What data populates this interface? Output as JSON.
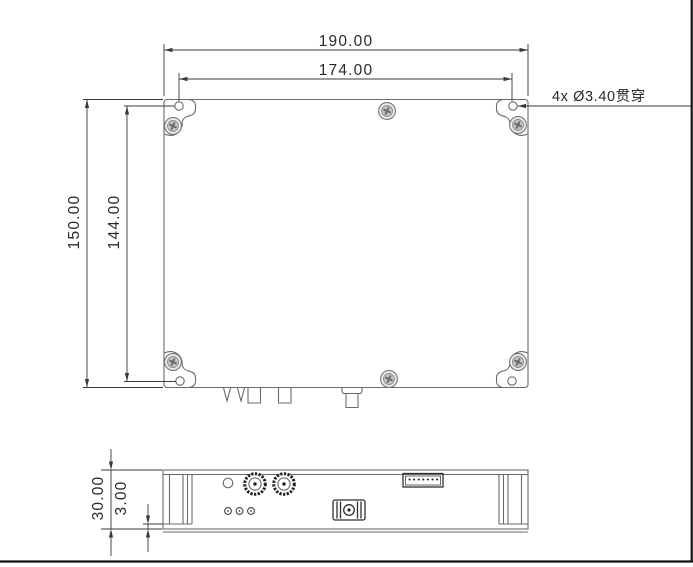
{
  "page": {
    "background": "#ffffff"
  },
  "colors": {
    "model_line": "#6a6a6a",
    "feature_line": "#2f2f2f",
    "dimension_line": "#3a3a3a",
    "text": "#2a2a2a",
    "frame": "#111111"
  },
  "top_view": {
    "dim_width_outer": "190.00",
    "dim_width_hole_span": "174.00",
    "dim_height_outer": "150.00",
    "dim_height_hole_span": "144.00",
    "hole_note": "4x Ø3.40贯穿"
  },
  "side_view": {
    "dim_height_overall": "30.00",
    "dim_base_plate": "3.00"
  }
}
